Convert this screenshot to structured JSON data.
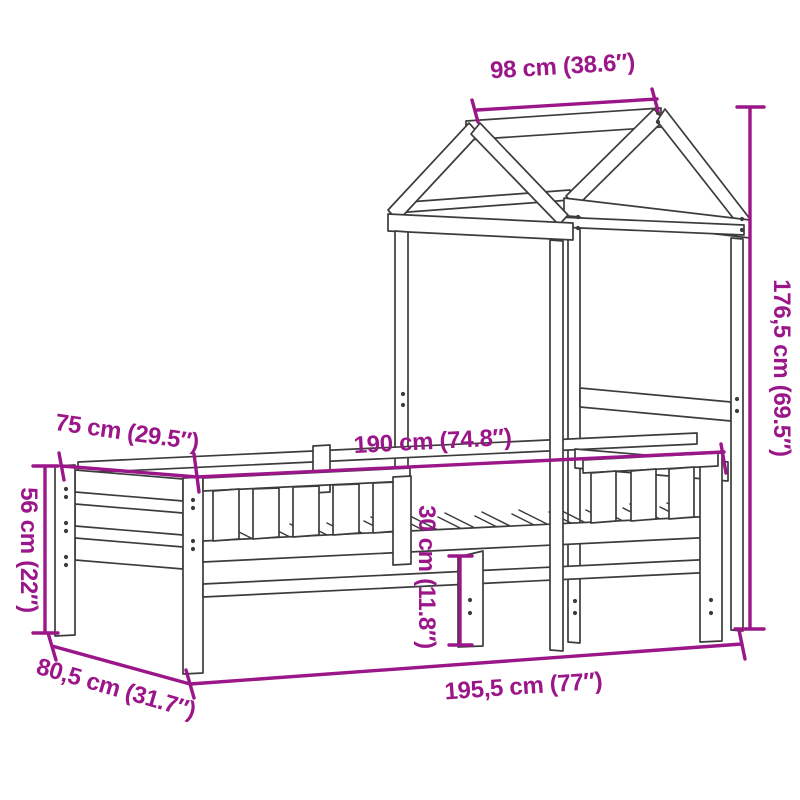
{
  "diagram": {
    "title": "bed-frame-with-house-roof-dimension-drawing",
    "background_color": "#ffffff",
    "drawing_line_color": "#3c3c3c",
    "dimension_color": "#9b1688",
    "dimensions": [
      {
        "id": "roof-ridge-length",
        "label": "98 cm (38.6″)"
      },
      {
        "id": "total-height",
        "label": "176,5 cm (69.5″)"
      },
      {
        "id": "bed-inner-width",
        "label": "75 cm (29.5″)"
      },
      {
        "id": "bed-inner-length",
        "label": "190 cm (74.8″)"
      },
      {
        "id": "headboard-height",
        "label": "56 cm (22″)"
      },
      {
        "id": "under-bed-clearance",
        "label": "30 cm (11.8″)"
      },
      {
        "id": "total-width",
        "label": "80,5 cm (31.7″)"
      },
      {
        "id": "total-length",
        "label": "195,5 cm (77″)"
      }
    ]
  }
}
